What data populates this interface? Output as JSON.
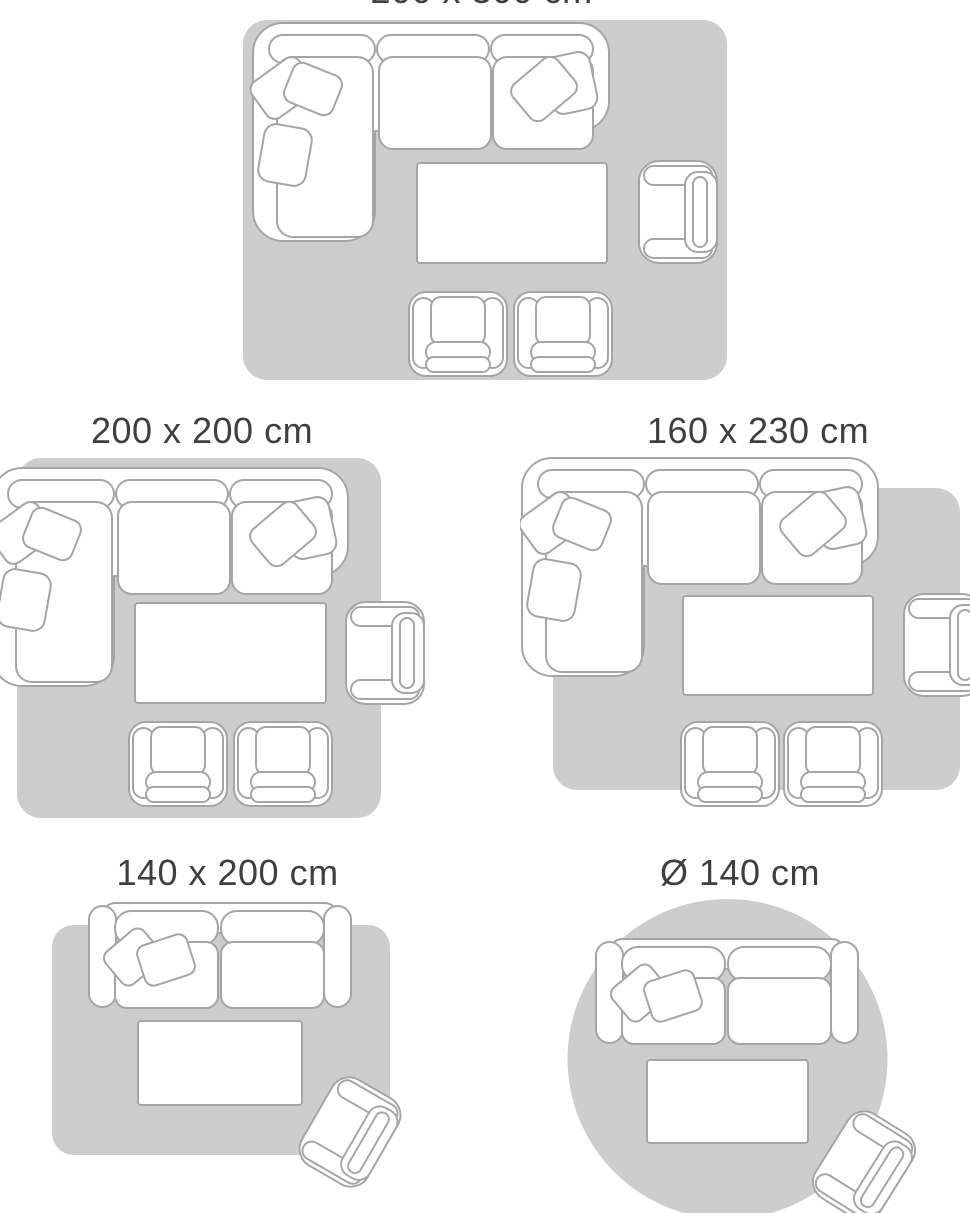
{
  "page": {
    "title": "Rug size guide",
    "background": "#ffffff"
  },
  "colors": {
    "rug_fill": "#cdcdcd",
    "furniture_fill": "#ffffff",
    "furniture_stroke": "#a5a5a5",
    "label_text": "#3f3f3f"
  },
  "size_guide": {
    "layouts": [
      {
        "id": "rug-200x300",
        "label": "200 x 300 cm",
        "shape": "rectangle",
        "scene": "corner-sofa, coffee-table, armchair, two-footstool-chairs",
        "label_partially_cut_off": true
      },
      {
        "id": "rug-200x200",
        "label": "200 x 200 cm",
        "shape": "rectangle",
        "scene": "corner-sofa, coffee-table, armchair, two-footstool-chairs"
      },
      {
        "id": "rug-160x230",
        "label": "160 x 230 cm",
        "shape": "rectangle",
        "scene": "corner-sofa, coffee-table, armchair, two-footstool-chairs"
      },
      {
        "id": "rug-140x200",
        "label": "140 x 200 cm",
        "shape": "rectangle",
        "scene": "two-seat-sofa, coffee-table, tilted-armchair"
      },
      {
        "id": "rug-d140",
        "label": "Ø 140 cm",
        "shape": "circle",
        "scene": "two-seat-sofa, coffee-table, tilted-armchair"
      }
    ]
  },
  "illustrations": [
    "corner-sofa-top-view",
    "two-seat-sofa-top-view",
    "armchair-top-view",
    "footstool-chair-top-view",
    "coffee-table-top-view",
    "rug-rectangle",
    "rug-circle"
  ]
}
